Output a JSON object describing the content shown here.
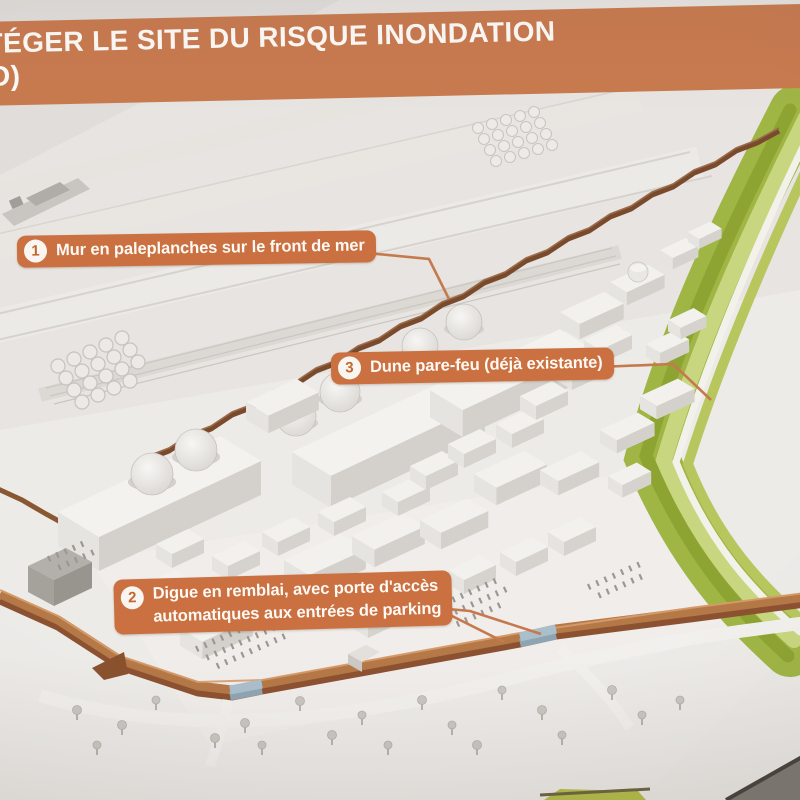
{
  "header": {
    "title_line1": "TÉGER LE SITE DU RISQUE INONDATION",
    "title_line2": "IO)"
  },
  "callouts": [
    {
      "number": "1",
      "label": "Mur en paleplanches sur le front de mer"
    },
    {
      "number": "2",
      "label_lines": [
        "Digue en remblai, avec porte d'accès",
        "automatiques aux entrées de parking"
      ]
    },
    {
      "number": "3",
      "label": "Dune pare-feu (déjà existante)"
    }
  ],
  "colors": {
    "banner_orange": "#c97a4f",
    "callout_orange": "#cb7040",
    "badge_number_orange": "#c4672f",
    "sea_wall_brown": "#7a4a2d",
    "dike_brown": "#b57847",
    "gate_blue": "#aabfcc",
    "dune_green": "#9fb544"
  }
}
